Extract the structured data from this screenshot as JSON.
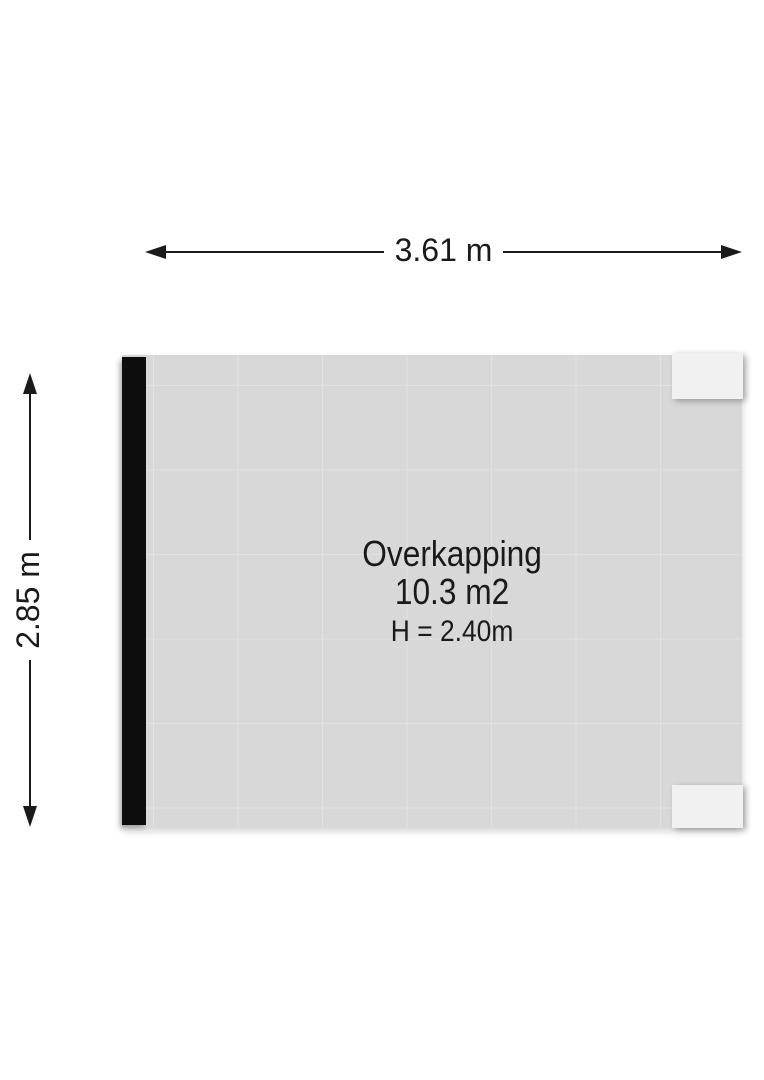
{
  "dimensions": {
    "width_label": "3.61 m",
    "height_label": "2.85 m"
  },
  "room": {
    "name": "Overkapping",
    "area": "10.3 m2",
    "ceiling_height": "H = 2.40m"
  },
  "colors": {
    "background": "#ffffff",
    "floor": "#d8d8d8",
    "grid_line": "#e2e2e2",
    "wall": "#0d0d0d",
    "fixture": "#f1f1f1",
    "ink": "#1a1a1a"
  }
}
